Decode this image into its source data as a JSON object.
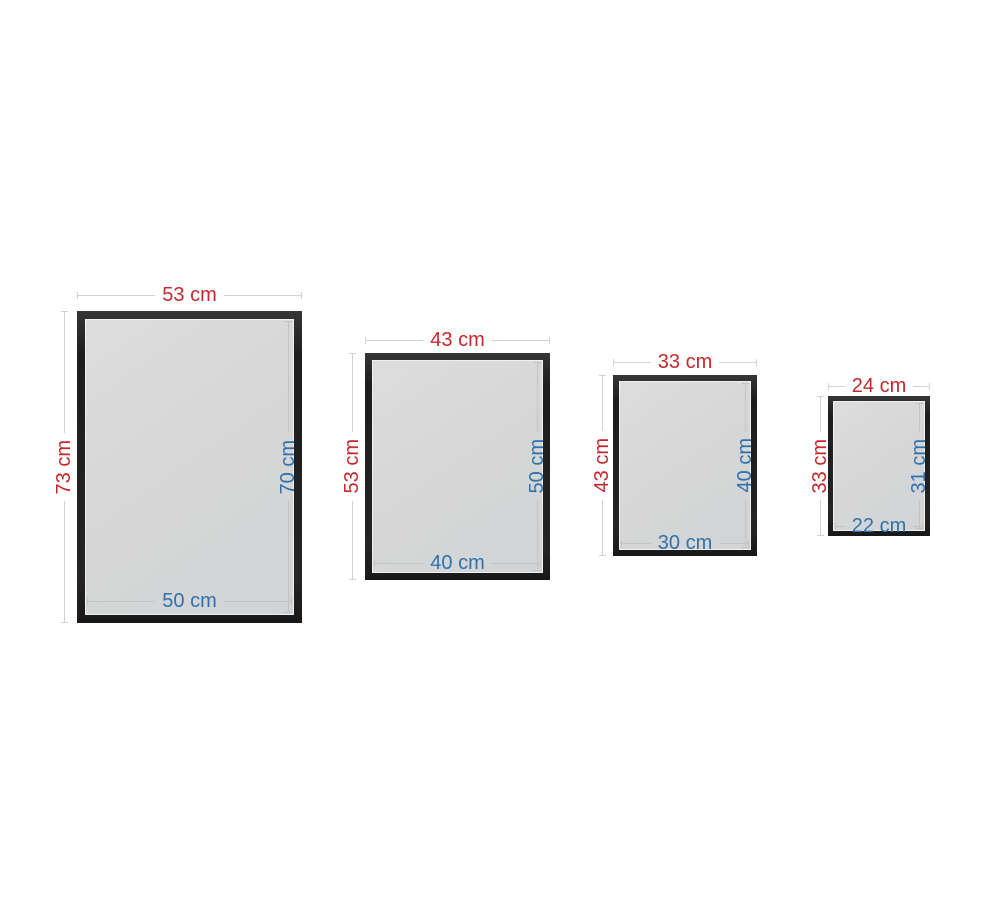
{
  "unit": "cm",
  "colors": {
    "outer_dimension": "#c5282d",
    "inner_dimension": "#2f72ad",
    "frame_black": "#232323",
    "glass_gray": "#d7d7d7",
    "dimension_line": "#d2d2d2",
    "background": "#ffffff"
  },
  "frames": [
    {
      "outer_width": "53 cm",
      "outer_height": "73 cm",
      "inner_width": "50 cm",
      "inner_height": "70 cm"
    },
    {
      "outer_width": "43 cm",
      "outer_height": "53 cm",
      "inner_width": "40 cm",
      "inner_height": "50 cm"
    },
    {
      "outer_width": "33 cm",
      "outer_height": "43 cm",
      "inner_width": "30 cm",
      "inner_height": "40 cm"
    },
    {
      "outer_width": "24 cm",
      "outer_height": "33 cm",
      "inner_width": "22 cm",
      "inner_height": "31 cm"
    }
  ]
}
